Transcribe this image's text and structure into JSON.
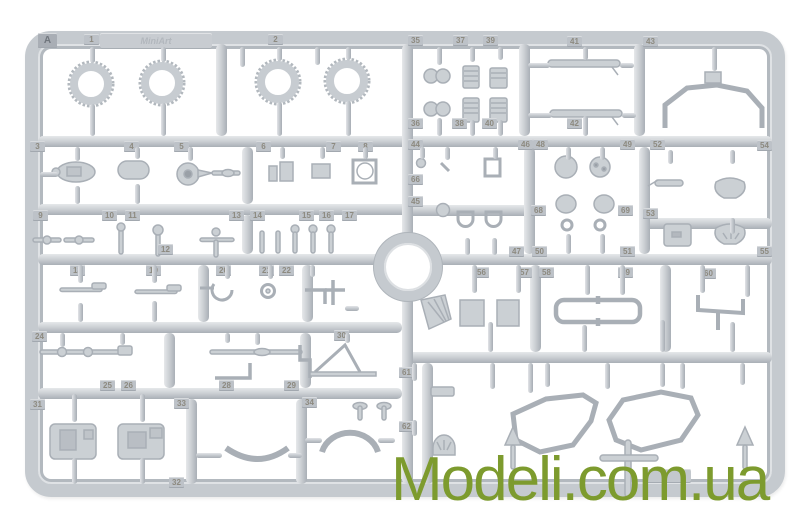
{
  "image": {
    "description": "Product photo of a light-grey injection-moulded plastic model kit sprue (parts frame) on a white background",
    "background_color": "#ffffff"
  },
  "sprue": {
    "gate_letter": "A",
    "brand_logo": "MiniArt",
    "plastic_color": "#c5cacf",
    "part_tags": [
      {
        "label": "A",
        "x": 38,
        "y": 33
      },
      {
        "label": "1",
        "x": 84,
        "y": 34
      },
      {
        "label": "2",
        "x": 268,
        "y": 34
      },
      {
        "label": "35",
        "x": 408,
        "y": 35
      },
      {
        "label": "37",
        "x": 453,
        "y": 35
      },
      {
        "label": "39",
        "x": 483,
        "y": 35
      },
      {
        "label": "41",
        "x": 567,
        "y": 36
      },
      {
        "label": "43",
        "x": 643,
        "y": 36
      },
      {
        "label": "36",
        "x": 408,
        "y": 118
      },
      {
        "label": "38",
        "x": 452,
        "y": 118
      },
      {
        "label": "40",
        "x": 482,
        "y": 118
      },
      {
        "label": "42",
        "x": 567,
        "y": 118
      },
      {
        "label": "3",
        "x": 30,
        "y": 141
      },
      {
        "label": "4",
        "x": 124,
        "y": 141
      },
      {
        "label": "5",
        "x": 174,
        "y": 141
      },
      {
        "label": "6",
        "x": 256,
        "y": 141
      },
      {
        "label": "7",
        "x": 326,
        "y": 141
      },
      {
        "label": "8",
        "x": 358,
        "y": 141
      },
      {
        "label": "44",
        "x": 408,
        "y": 139
      },
      {
        "label": "46",
        "x": 518,
        "y": 139
      },
      {
        "label": "48",
        "x": 533,
        "y": 139
      },
      {
        "label": "49",
        "x": 620,
        "y": 139
      },
      {
        "label": "52",
        "x": 650,
        "y": 139
      },
      {
        "label": "54",
        "x": 757,
        "y": 140
      },
      {
        "label": "66",
        "x": 408,
        "y": 174
      },
      {
        "label": "45",
        "x": 408,
        "y": 196
      },
      {
        "label": "68",
        "x": 531,
        "y": 205
      },
      {
        "label": "69",
        "x": 618,
        "y": 205
      },
      {
        "label": "53",
        "x": 643,
        "y": 208
      },
      {
        "label": "9",
        "x": 33,
        "y": 210
      },
      {
        "label": "10",
        "x": 102,
        "y": 210
      },
      {
        "label": "11",
        "x": 125,
        "y": 210
      },
      {
        "label": "13",
        "x": 229,
        "y": 210
      },
      {
        "label": "14",
        "x": 250,
        "y": 210
      },
      {
        "label": "15",
        "x": 299,
        "y": 210
      },
      {
        "label": "16",
        "x": 319,
        "y": 210
      },
      {
        "label": "17",
        "x": 342,
        "y": 210
      },
      {
        "label": "12",
        "x": 158,
        "y": 244
      },
      {
        "label": "47",
        "x": 509,
        "y": 246
      },
      {
        "label": "50",
        "x": 532,
        "y": 246
      },
      {
        "label": "51",
        "x": 620,
        "y": 246
      },
      {
        "label": "55",
        "x": 757,
        "y": 246
      },
      {
        "label": "18",
        "x": 70,
        "y": 265
      },
      {
        "label": "19",
        "x": 146,
        "y": 265
      },
      {
        "label": "20",
        "x": 216,
        "y": 265
      },
      {
        "label": "21",
        "x": 259,
        "y": 265
      },
      {
        "label": "22",
        "x": 279,
        "y": 265
      },
      {
        "label": "56",
        "x": 474,
        "y": 267
      },
      {
        "label": "57",
        "x": 517,
        "y": 267
      },
      {
        "label": "58",
        "x": 539,
        "y": 267
      },
      {
        "label": "59",
        "x": 618,
        "y": 267
      },
      {
        "label": "60",
        "x": 701,
        "y": 268
      },
      {
        "label": "24",
        "x": 32,
        "y": 331
      },
      {
        "label": "30",
        "x": 334,
        "y": 330
      },
      {
        "label": "61",
        "x": 399,
        "y": 367
      },
      {
        "label": "62",
        "x": 399,
        "y": 421
      },
      {
        "label": "25",
        "x": 100,
        "y": 380
      },
      {
        "label": "26",
        "x": 121,
        "y": 380
      },
      {
        "label": "28",
        "x": 219,
        "y": 380
      },
      {
        "label": "29",
        "x": 284,
        "y": 380
      },
      {
        "label": "31",
        "x": 30,
        "y": 399
      },
      {
        "label": "33",
        "x": 174,
        "y": 398
      },
      {
        "label": "34",
        "x": 302,
        "y": 397
      },
      {
        "label": "32",
        "x": 169,
        "y": 477
      }
    ],
    "pins": [
      {
        "x": 90,
        "y": 47,
        "len": 16
      },
      {
        "x": 161,
        "y": 47,
        "len": 15
      },
      {
        "x": 277,
        "y": 47,
        "len": 14
      },
      {
        "x": 346,
        "y": 47,
        "len": 13
      },
      {
        "x": 90,
        "y": 104,
        "len": 32
      },
      {
        "x": 161,
        "y": 103,
        "len": 33
      },
      {
        "x": 277,
        "y": 102,
        "len": 34
      },
      {
        "x": 346,
        "y": 101,
        "len": 35
      },
      {
        "x": 240,
        "y": 47,
        "len": 20
      },
      {
        "x": 315,
        "y": 47,
        "len": 18
      },
      {
        "x": 437,
        "y": 47,
        "len": 18
      },
      {
        "x": 470,
        "y": 47,
        "len": 15
      },
      {
        "x": 498,
        "y": 47,
        "len": 13
      },
      {
        "x": 437,
        "y": 118,
        "len": 18
      },
      {
        "x": 470,
        "y": 120,
        "len": 16
      },
      {
        "x": 498,
        "y": 120,
        "len": 16
      },
      {
        "x": 583,
        "y": 47,
        "len": 13
      },
      {
        "x": 583,
        "y": 116,
        "len": 20
      },
      {
        "x": 712,
        "y": 47,
        "len": 24
      },
      {
        "x": 75,
        "y": 147,
        "len": 14
      },
      {
        "x": 135,
        "y": 147,
        "len": 12
      },
      {
        "x": 188,
        "y": 147,
        "len": 14
      },
      {
        "x": 280,
        "y": 147,
        "len": 12
      },
      {
        "x": 320,
        "y": 147,
        "len": 12
      },
      {
        "x": 363,
        "y": 147,
        "len": 12
      },
      {
        "x": 75,
        "y": 186,
        "len": 18
      },
      {
        "x": 135,
        "y": 184,
        "len": 20
      },
      {
        "x": 420,
        "y": 147,
        "len": 12
      },
      {
        "x": 445,
        "y": 147,
        "len": 13
      },
      {
        "x": 493,
        "y": 147,
        "len": 12
      },
      {
        "x": 465,
        "y": 238,
        "len": 17
      },
      {
        "x": 492,
        "y": 238,
        "len": 17
      },
      {
        "x": 566,
        "y": 147,
        "len": 13
      },
      {
        "x": 600,
        "y": 147,
        "len": 13
      },
      {
        "x": 566,
        "y": 234,
        "len": 20
      },
      {
        "x": 600,
        "y": 234,
        "len": 20
      },
      {
        "x": 668,
        "y": 150,
        "len": 14
      },
      {
        "x": 730,
        "y": 150,
        "len": 14
      },
      {
        "x": 730,
        "y": 218,
        "len": 16
      },
      {
        "x": 78,
        "y": 265,
        "len": 18
      },
      {
        "x": 152,
        "y": 265,
        "len": 18
      },
      {
        "x": 225,
        "y": 265,
        "len": 14
      },
      {
        "x": 268,
        "y": 265,
        "len": 14
      },
      {
        "x": 310,
        "y": 265,
        "len": 12
      },
      {
        "x": 78,
        "y": 303,
        "len": 19
      },
      {
        "x": 152,
        "y": 301,
        "len": 21
      },
      {
        "x": 60,
        "y": 333,
        "len": 14
      },
      {
        "x": 120,
        "y": 333,
        "len": 12
      },
      {
        "x": 225,
        "y": 333,
        "len": 10
      },
      {
        "x": 255,
        "y": 333,
        "len": 12
      },
      {
        "x": 345,
        "y": 333,
        "len": 10
      },
      {
        "x": 72,
        "y": 394,
        "len": 28
      },
      {
        "x": 140,
        "y": 394,
        "len": 28
      },
      {
        "x": 72,
        "y": 458,
        "len": 26
      },
      {
        "x": 140,
        "y": 458,
        "len": 26
      },
      {
        "x": 472,
        "y": 265,
        "len": 28
      },
      {
        "x": 516,
        "y": 265,
        "len": 28
      },
      {
        "x": 585,
        "y": 265,
        "len": 30
      },
      {
        "x": 620,
        "y": 265,
        "len": 30
      },
      {
        "x": 700,
        "y": 265,
        "len": 28
      },
      {
        "x": 745,
        "y": 265,
        "len": 32
      },
      {
        "x": 488,
        "y": 322,
        "len": 30
      },
      {
        "x": 582,
        "y": 325,
        "len": 27
      },
      {
        "x": 660,
        "y": 320,
        "len": 32
      },
      {
        "x": 730,
        "y": 322,
        "len": 30
      },
      {
        "x": 490,
        "y": 363,
        "len": 26
      },
      {
        "x": 545,
        "y": 363,
        "len": 24
      },
      {
        "x": 605,
        "y": 363,
        "len": 26
      },
      {
        "x": 660,
        "y": 363,
        "len": 24
      },
      {
        "x": 740,
        "y": 363,
        "len": 22
      },
      {
        "x": 412,
        "y": 363,
        "len": 18
      },
      {
        "x": 412,
        "y": 420,
        "len": 16
      },
      {
        "x": 528,
        "y": 363,
        "len": 30
      },
      {
        "x": 680,
        "y": 363,
        "len": 26
      }
    ],
    "stubs": [
      {
        "x": 196,
        "y": 453,
        "len": 26
      },
      {
        "x": 288,
        "y": 453,
        "len": 14
      },
      {
        "x": 305,
        "y": 438,
        "len": 17
      },
      {
        "x": 378,
        "y": 438,
        "len": 17
      },
      {
        "x": 528,
        "y": 63,
        "len": 22
      },
      {
        "x": 528,
        "y": 113,
        "len": 24
      },
      {
        "x": 620,
        "y": 63,
        "len": 14
      },
      {
        "x": 622,
        "y": 113,
        "len": 14
      },
      {
        "x": 40,
        "y": 172,
        "len": 18
      },
      {
        "x": 345,
        "y": 306,
        "len": 14
      }
    ],
    "parts_visible": [
      "four treaded road wheels (tyres)",
      "twin exhaust pipes",
      "small engine detail blocks",
      "steering wheels and round hubs",
      "mirrors, horn and brackets",
      "levers, rods and control pins",
      "pipes and axle assemblies",
      "two engine blocks",
      "seat cushion and wheel arch",
      "two windscreen frames",
      "roll-bar frame",
      "headlight dome"
    ]
  },
  "watermark": {
    "text": "Modeli.com.ua",
    "color": "#7d9b2e"
  }
}
